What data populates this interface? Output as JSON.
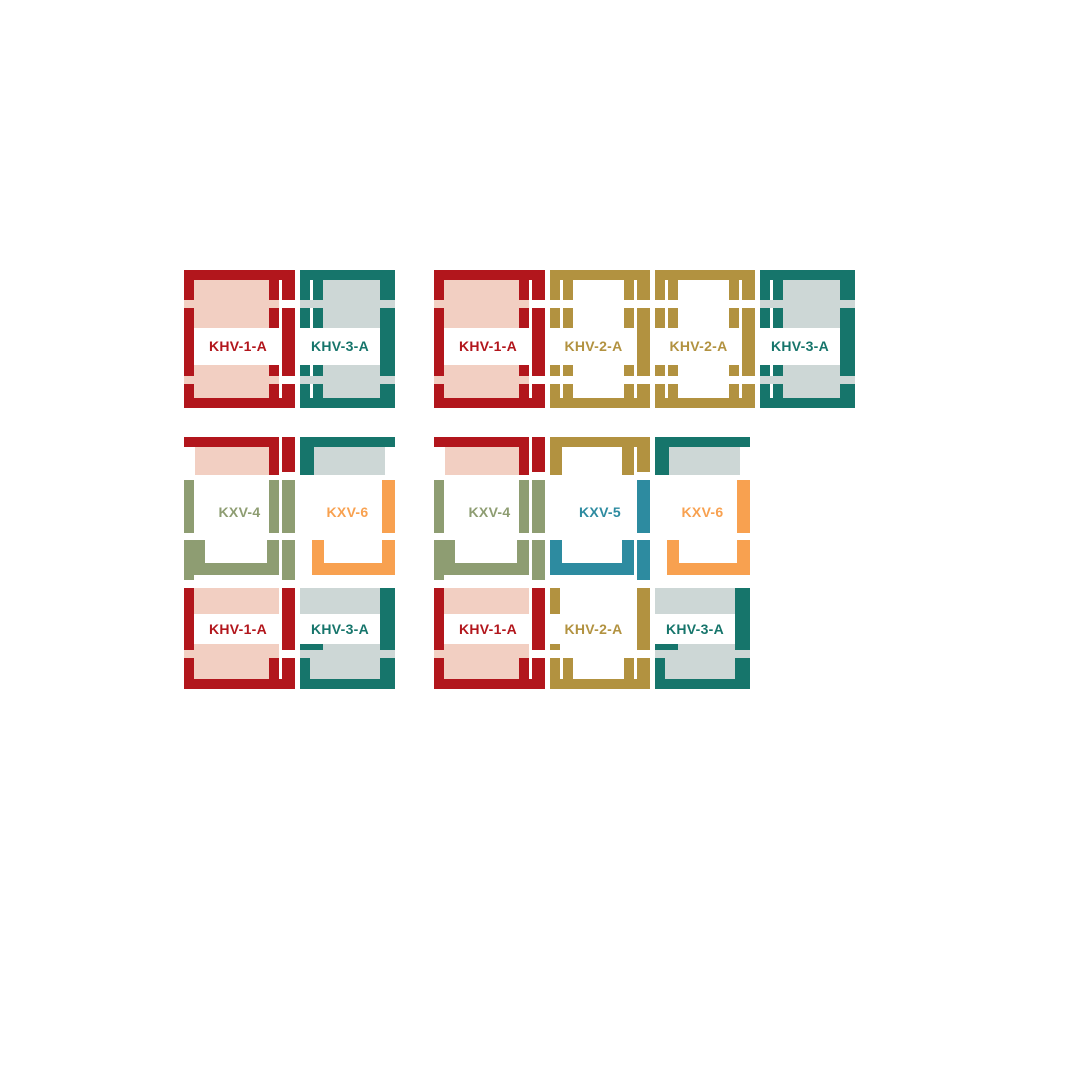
{
  "diagram": {
    "description": "Roof window flashing combination diagrams",
    "colors": {
      "red": "#b2161c",
      "salmon_fill": "#f2cfc2",
      "teal": "#16756b",
      "gray_blue_fill": "#cdd7d6",
      "gold": "#b29240",
      "olive": "#8e9d72",
      "orange": "#f8a150",
      "blue": "#2d8ba0",
      "background": "#ffffff"
    },
    "groups": [
      {
        "name": "two-windows-side-by-side",
        "cells": [
          {
            "label": "KHV-1-A",
            "color": "red"
          },
          {
            "label": "KHV-3-A",
            "color": "teal"
          }
        ]
      },
      {
        "name": "four-windows-side-by-side",
        "cells": [
          {
            "label": "KHV-1-A",
            "color": "red"
          },
          {
            "label": "KHV-2-A",
            "color": "gold"
          },
          {
            "label": "KHV-2-A",
            "color": "gold"
          },
          {
            "label": "KHV-3-A",
            "color": "teal"
          }
        ]
      },
      {
        "name": "two-by-two-grid",
        "cells": [
          {
            "label": "KXV-4",
            "color": "olive"
          },
          {
            "label": "KXV-6",
            "color": "orange"
          },
          {
            "label": "KHV-1-A",
            "color": "red"
          },
          {
            "label": "KHV-3-A",
            "color": "teal"
          }
        ]
      },
      {
        "name": "three-by-two-grid",
        "cells": [
          {
            "label": "KXV-4",
            "color": "olive"
          },
          {
            "label": "KXV-5",
            "color": "blue"
          },
          {
            "label": "KXV-6",
            "color": "orange"
          },
          {
            "label": "KHV-1-A",
            "color": "red"
          },
          {
            "label": "KHV-2-A",
            "color": "gold"
          },
          {
            "label": "KHV-3-A",
            "color": "teal"
          }
        ]
      }
    ]
  }
}
